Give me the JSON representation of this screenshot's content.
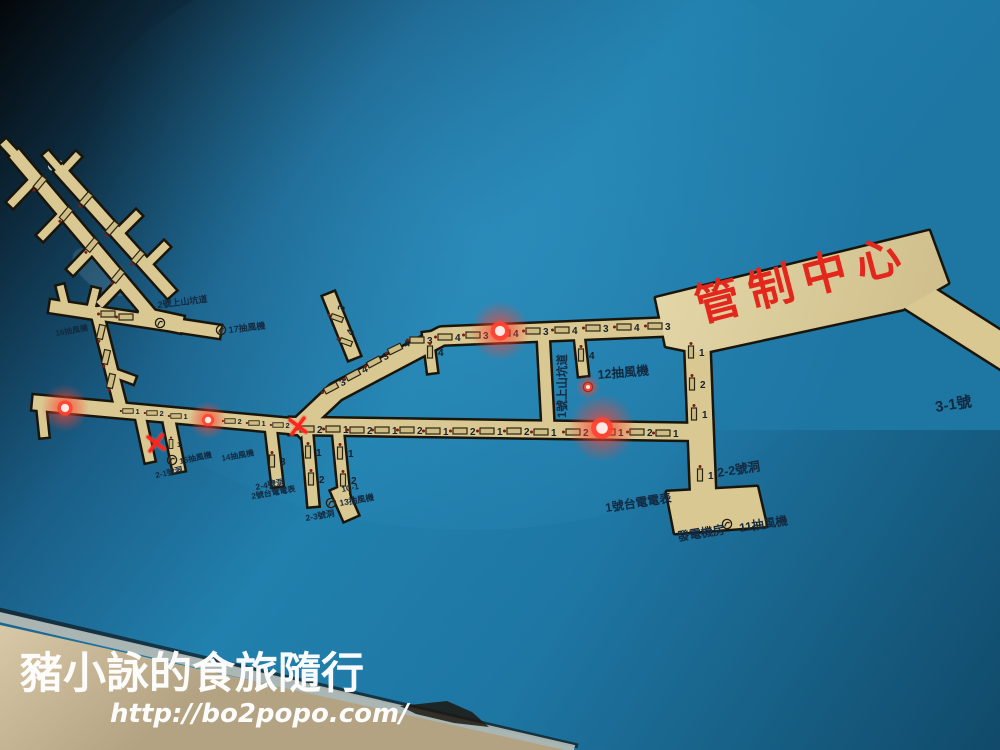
{
  "photo_subject": "tunnel network map board with indicator lights",
  "watermark": {
    "line1": "豬小詠的食旅隨行",
    "line2": "http://bo2popo.com/"
  },
  "colors": {
    "board_blue": "#1e7aa8",
    "board_highlight": "#3396c6",
    "tunnel_tan": "#d9c892",
    "outline_dark": "#1a150b",
    "led_red": "#ff4331",
    "accent_red": "#e3271c",
    "wall_beige": "#cdbc9b",
    "watermark_white": "#ffffff",
    "label_navy": "#13293f"
  },
  "map": {
    "control_center": {
      "text": "管制中心"
    },
    "labels": [
      {
        "name": "label-3-1-hole",
        "text": "3-1號",
        "x": 936,
        "y": 412,
        "fs": 15,
        "rot": -9
      },
      {
        "name": "label-12-fan",
        "text": "12抽風機",
        "x": 598,
        "y": 379,
        "fs": 12.5,
        "rot": -5
      },
      {
        "name": "label-1-uphill-tunnel",
        "text": "1號上山坑道",
        "x": 566,
        "y": 418,
        "fs": 11.5,
        "rot": -90
      },
      {
        "name": "label-2-2-hole",
        "text": "2-2號洞",
        "x": 718,
        "y": 477,
        "fs": 12.5,
        "rot": -9
      },
      {
        "name": "label-taipower-meter-1",
        "text": "1號台電電表",
        "x": 606,
        "y": 512,
        "fs": 12,
        "rot": -9
      },
      {
        "name": "label-generator-room",
        "text": "發電機房",
        "x": 678,
        "y": 541,
        "fs": 12,
        "rot": -9
      },
      {
        "name": "label-11-fan",
        "text": "11抽風機",
        "x": 740,
        "y": 532,
        "fs": 12,
        "rot": -9
      },
      {
        "name": "label-1c-1",
        "text": "1C-1",
        "x": 342,
        "y": 492,
        "fs": 8,
        "rot": -10
      },
      {
        "name": "label-13-fan",
        "text": "13抽風機",
        "x": 340,
        "y": 506,
        "fs": 8.5,
        "rot": -10
      },
      {
        "name": "label-2-3-hole",
        "text": "2-3號洞",
        "x": 306,
        "y": 521,
        "fs": 8.5,
        "rot": -10
      },
      {
        "name": "label-2-4-hole",
        "text": "2-4號洞",
        "x": 256,
        "y": 490,
        "fs": 8.5,
        "rot": -10
      },
      {
        "name": "label-taipower-meter-2",
        "text": "2號台電電表",
        "x": 252,
        "y": 499,
        "fs": 8,
        "rot": -10
      },
      {
        "name": "label-2-1-hole",
        "text": "2-1號洞",
        "x": 156,
        "y": 478,
        "fs": 8,
        "rot": -12
      },
      {
        "name": "label-15-fan",
        "text": "15抽風機",
        "x": 180,
        "y": 464,
        "fs": 8,
        "rot": -12
      },
      {
        "name": "label-14-fan",
        "text": "14抽風機",
        "x": 222,
        "y": 461,
        "fs": 8,
        "rot": -10
      },
      {
        "name": "label-2-uphill-tunnel",
        "text": "2號上山坑道",
        "x": 158,
        "y": 308,
        "fs": 9,
        "rot": -7
      },
      {
        "name": "label-17-fan",
        "text": "17抽風機",
        "x": 229,
        "y": 333,
        "fs": 9,
        "rot": -7
      },
      {
        "name": "label-16-fan",
        "text": "16抽風機",
        "x": 56,
        "y": 336,
        "fs": 8,
        "rot": -10
      }
    ],
    "markers": [
      {
        "x": 331,
        "y": 388,
        "n": "3",
        "r": -28
      },
      {
        "x": 353,
        "y": 375,
        "n": "4",
        "r": -28
      },
      {
        "x": 374,
        "y": 362,
        "n": "3",
        "r": -28
      },
      {
        "x": 395,
        "y": 349,
        "n": "4",
        "r": -26
      },
      {
        "x": 417,
        "y": 340,
        "n": "3"
      },
      {
        "x": 445,
        "y": 337,
        "n": "4"
      },
      {
        "x": 473,
        "y": 335,
        "n": "3"
      },
      {
        "x": 503,
        "y": 333,
        "n": "4"
      },
      {
        "x": 533,
        "y": 331,
        "n": "3"
      },
      {
        "x": 562,
        "y": 330,
        "n": "4"
      },
      {
        "x": 593,
        "y": 328,
        "n": "3"
      },
      {
        "x": 624,
        "y": 327,
        "n": "4"
      },
      {
        "x": 655,
        "y": 326,
        "n": "3"
      },
      {
        "x": 337,
        "y": 318,
        "n": "3",
        "r": -70,
        "v": 1
      },
      {
        "x": 346,
        "y": 342,
        "n": "4",
        "r": -70,
        "v": 1
      },
      {
        "x": 430,
        "y": 352,
        "n": "4",
        "v": 1
      },
      {
        "x": 581,
        "y": 355,
        "n": "4",
        "v": 1
      },
      {
        "x": 307,
        "y": 429,
        "n": "2"
      },
      {
        "x": 333,
        "y": 429,
        "n": "1"
      },
      {
        "x": 357,
        "y": 430,
        "n": "2"
      },
      {
        "x": 382,
        "y": 430,
        "n": "1"
      },
      {
        "x": 407,
        "y": 430,
        "n": "2"
      },
      {
        "x": 433,
        "y": 431,
        "n": "1"
      },
      {
        "x": 460,
        "y": 431,
        "n": "2"
      },
      {
        "x": 487,
        "y": 431,
        "n": "1"
      },
      {
        "x": 514,
        "y": 431,
        "n": "2"
      },
      {
        "x": 541,
        "y": 432,
        "n": "1"
      },
      {
        "x": 573,
        "y": 432,
        "n": "2"
      },
      {
        "x": 608,
        "y": 432,
        "n": "1"
      },
      {
        "x": 637,
        "y": 432,
        "n": "2"
      },
      {
        "x": 663,
        "y": 433,
        "n": "1"
      },
      {
        "x": 128,
        "y": 411,
        "n": "1",
        "sc": 0.75
      },
      {
        "x": 152,
        "y": 413,
        "n": "2",
        "sc": 0.75
      },
      {
        "x": 176,
        "y": 416,
        "n": "1",
        "sc": 0.75
      },
      {
        "x": 230,
        "y": 421,
        "n": "2",
        "sc": 0.75
      },
      {
        "x": 254,
        "y": 423,
        "n": "1",
        "sc": 0.75
      },
      {
        "x": 278,
        "y": 425,
        "n": "2",
        "sc": 0.75
      },
      {
        "x": 171,
        "y": 444,
        "n": "1",
        "v": 1,
        "sc": 0.75
      },
      {
        "x": 691,
        "y": 352,
        "n": "1",
        "v": 1
      },
      {
        "x": 692,
        "y": 384,
        "n": "2",
        "v": 1
      },
      {
        "x": 694,
        "y": 414,
        "n": "1",
        "v": 1
      },
      {
        "x": 700,
        "y": 475,
        "n": "1",
        "v": 1
      },
      {
        "x": 272,
        "y": 461,
        "n": "3",
        "v": 1
      },
      {
        "x": 308,
        "y": 452,
        "n": "1",
        "v": 1
      },
      {
        "x": 311,
        "y": 479,
        "n": "2",
        "v": 1
      },
      {
        "x": 340,
        "y": 453,
        "n": "1",
        "v": 1
      },
      {
        "x": 343,
        "y": 480,
        "n": "2",
        "v": 1
      },
      {
        "x": 101,
        "y": 332,
        "n": "",
        "r": -77
      },
      {
        "x": 106,
        "y": 357,
        "n": "",
        "r": -77
      },
      {
        "x": 111,
        "y": 381,
        "n": "",
        "r": -77
      },
      {
        "x": 40,
        "y": 183,
        "n": "",
        "r": -50
      },
      {
        "x": 66,
        "y": 214,
        "n": "",
        "r": -50
      },
      {
        "x": 92,
        "y": 245,
        "n": "",
        "r": -50
      },
      {
        "x": 118,
        "y": 276,
        "n": "",
        "r": -50
      },
      {
        "x": 86,
        "y": 199,
        "n": "",
        "r": -49
      },
      {
        "x": 112,
        "y": 228,
        "n": "",
        "r": -49
      },
      {
        "x": 138,
        "y": 257,
        "n": "",
        "r": -49
      },
      {
        "x": 108,
        "y": 314,
        "n": ""
      },
      {
        "x": 126,
        "y": 317,
        "n": ""
      }
    ],
    "fans": [
      {
        "x": 221,
        "y": 330
      },
      {
        "x": 160,
        "y": 323
      },
      {
        "x": 172,
        "y": 460
      },
      {
        "x": 331,
        "y": 503
      },
      {
        "x": 588,
        "y": 387
      },
      {
        "x": 727,
        "y": 524
      }
    ],
    "leds": [
      {
        "x": 65,
        "y": 408,
        "halo": 24
      },
      {
        "x": 208,
        "y": 420,
        "halo": 19
      },
      {
        "x": 500,
        "y": 331,
        "halo": 30
      },
      {
        "x": 602,
        "y": 428,
        "halo": 34
      },
      {
        "x": 588,
        "y": 387,
        "halo": 12
      }
    ],
    "x_marks": [
      {
        "x": 298,
        "y": 426
      },
      {
        "x": 156,
        "y": 443
      }
    ]
  }
}
